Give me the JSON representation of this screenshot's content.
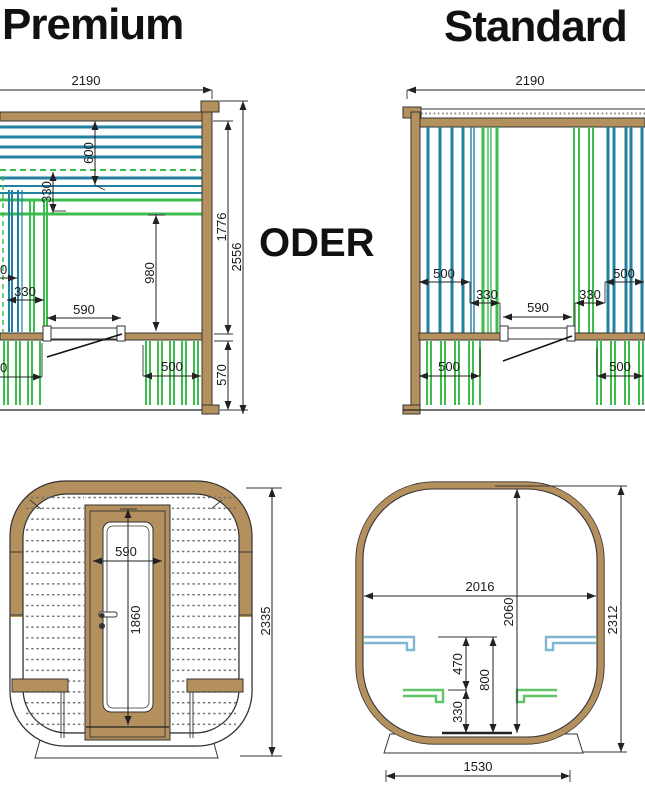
{
  "titles": {
    "left": "Premium",
    "right": "Standard",
    "conjunction": "ODER"
  },
  "colors": {
    "teal_slat": "#2281A2",
    "green_slat": "#3CBE4C",
    "wood": "#B5905F",
    "bracket_blue": "#7FB7D2",
    "bracket_green": "#5EC468",
    "outline": "#333333",
    "dimension": "#222222"
  },
  "premium": {
    "dims": {
      "width": "2190",
      "backrest_height": "600",
      "backrest_gap": "330",
      "cut_left": "0",
      "seat_depth": "330",
      "bench_height": "980",
      "step_width": "590",
      "cut_bottom_left": "0",
      "under_bench_right": "500",
      "base_height": "570",
      "inner_height": "1776",
      "total_height": "2556"
    }
  },
  "standard": {
    "dims": {
      "width": "2190",
      "upper_left_500": "500",
      "upper_left_330": "330",
      "step_width": "590",
      "upper_right_330": "330",
      "upper_right_500": "500",
      "lower_left_500": "500",
      "lower_right_500": "500"
    }
  },
  "front_view": {
    "dims": {
      "door_width": "590",
      "door_height": "1860",
      "total_height": "2335"
    }
  },
  "section_view": {
    "dims": {
      "inner_width": "2016",
      "inner_height": "2060",
      "total_height": "2312",
      "bench_gap": "470",
      "upper_bench_height": "800",
      "lower_bench_height": "330",
      "base_width": "1530"
    }
  }
}
